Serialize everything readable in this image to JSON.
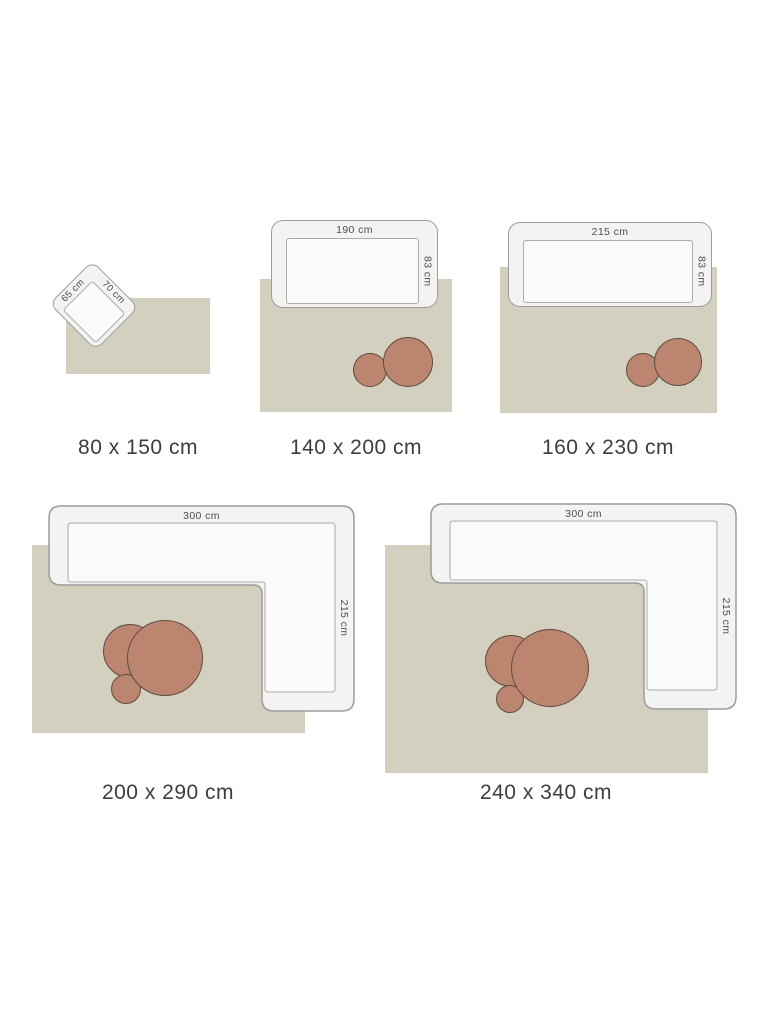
{
  "title": "rug-size-guide",
  "colors": {
    "rug": "#d3d0c0",
    "sofa_fill": "#f3f3f1",
    "sofa_border": "#9c9c9c",
    "seat_fill": "#fafaf9",
    "seat_border": "#ababab",
    "table_fill": "#bb8570",
    "table_border": "#5f4b40",
    "dim": "#4d4d4d",
    "caption": "#3d3d3d"
  },
  "groups": [
    {
      "caption": "80 x 150 cm",
      "furniture": {
        "type": "armchair",
        "width_label": "70 cm",
        "depth_label": "65 cm"
      },
      "tables": 0
    },
    {
      "caption": "140 x 200 cm",
      "furniture": {
        "type": "sofa",
        "width_label": "190 cm",
        "depth_label": "83 cm"
      },
      "tables": 2
    },
    {
      "caption": "160 x 230 cm",
      "furniture": {
        "type": "sofa",
        "width_label": "215 cm",
        "depth_label": "83 cm"
      },
      "tables": 2
    },
    {
      "caption": "200 x 290 cm",
      "furniture": {
        "type": "corner-sofa",
        "width_label": "300 cm",
        "depth_label": "215 cm"
      },
      "tables": 3
    },
    {
      "caption": "240 x 340 cm",
      "furniture": {
        "type": "corner-sofa",
        "width_label": "300 cm",
        "depth_label": "215 cm"
      },
      "tables": 3
    }
  ]
}
